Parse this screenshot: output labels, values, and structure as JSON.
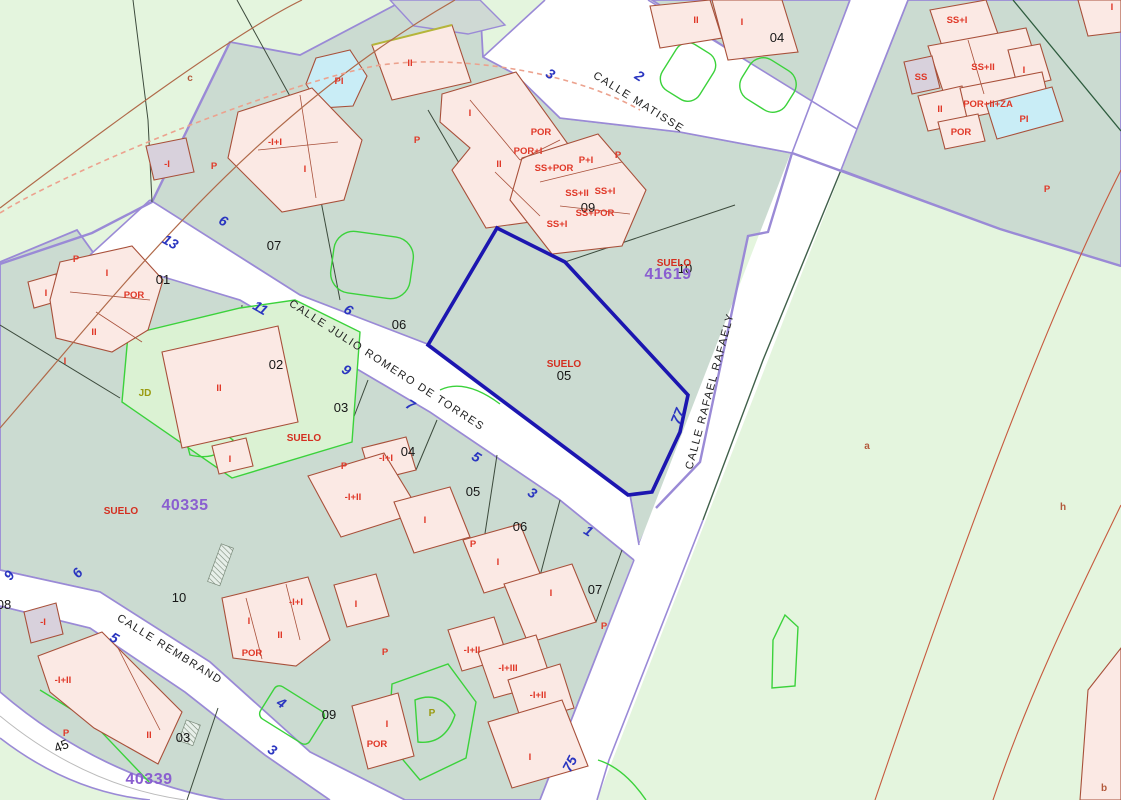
{
  "map_type": "cadastral-parcel-map",
  "colors": {
    "rustic": "#e4f5de",
    "parcel": "#cbdbd1",
    "street_edge": "#9a8ad6",
    "building_fill": "#fbe9e4",
    "building_stroke": "#a8503a",
    "pool": "#c9edf6",
    "garden_line": "#3bd23b",
    "selection": "#1c16b0",
    "label_red": "#e03828",
    "number_blue": "#2a35c0",
    "block_purple": "#8a5fd0"
  },
  "streets": [
    {
      "t": "CALLE MATISSE",
      "x": 637,
      "y": 105,
      "r": 32
    },
    {
      "t": "CALLE JULIO ROMERO DE TORRES",
      "x": 385,
      "y": 368,
      "r": 33
    },
    {
      "t": "CALLE RAFAEL RAFAELY",
      "x": 713,
      "y": 392,
      "r": -75
    },
    {
      "t": "CALLE REMBRAND",
      "x": 168,
      "y": 652,
      "r": 32
    }
  ],
  "street_numbers": [
    {
      "t": "3",
      "x": 548,
      "y": 78,
      "r": 32
    },
    {
      "t": "2",
      "x": 637,
      "y": 80,
      "r": 32
    },
    {
      "t": "6",
      "x": 221,
      "y": 225,
      "r": 30
    },
    {
      "t": "13",
      "x": 168,
      "y": 246,
      "r": 30
    },
    {
      "t": "11",
      "x": 258,
      "y": 312,
      "r": 30
    },
    {
      "t": "6",
      "x": 346,
      "y": 314,
      "r": 32
    },
    {
      "t": "9",
      "x": 344,
      "y": 374,
      "r": 32
    },
    {
      "t": "7",
      "x": 408,
      "y": 409,
      "r": 32
    },
    {
      "t": "5",
      "x": 474,
      "y": 461,
      "r": 32
    },
    {
      "t": "3",
      "x": 530,
      "y": 497,
      "r": 32
    },
    {
      "t": "1",
      "x": 586,
      "y": 535,
      "r": 32
    },
    {
      "t": "77",
      "x": 682,
      "y": 418,
      "r": -68
    },
    {
      "t": "75",
      "x": 574,
      "y": 766,
      "r": -62
    },
    {
      "t": "9",
      "x": 13,
      "y": 578,
      "r": -55
    },
    {
      "t": "6",
      "x": 81,
      "y": 576,
      "r": -50
    },
    {
      "t": "5",
      "x": 112,
      "y": 642,
      "r": 30
    },
    {
      "t": "4",
      "x": 279,
      "y": 707,
      "r": 32
    },
    {
      "t": "3",
      "x": 270,
      "y": 754,
      "r": 32
    }
  ],
  "parcel_numbers": [
    {
      "t": "04",
      "x": 777,
      "y": 42
    },
    {
      "t": "07",
      "x": 274,
      "y": 250
    },
    {
      "t": "01",
      "x": 163,
      "y": 284
    },
    {
      "t": "06",
      "x": 399,
      "y": 329
    },
    {
      "t": "02",
      "x": 276,
      "y": 369
    },
    {
      "t": "09",
      "x": 588,
      "y": 212
    },
    {
      "t": "10",
      "x": 685,
      "y": 273
    },
    {
      "t": "05",
      "x": 564,
      "y": 380
    },
    {
      "t": "03",
      "x": 341,
      "y": 412
    },
    {
      "t": "04",
      "x": 408,
      "y": 456
    },
    {
      "t": "05",
      "x": 473,
      "y": 496
    },
    {
      "t": "06",
      "x": 520,
      "y": 531
    },
    {
      "t": "07",
      "x": 595,
      "y": 594
    },
    {
      "t": "10",
      "x": 179,
      "y": 602
    },
    {
      "t": "08",
      "x": 4,
      "y": 609
    },
    {
      "t": "09",
      "x": 329,
      "y": 719
    },
    {
      "t": "03",
      "x": 183,
      "y": 742
    },
    {
      "t": "45",
      "x": 63,
      "y": 750,
      "r": -22
    }
  ],
  "block_numbers": [
    {
      "t": "41619",
      "x": 668,
      "y": 279
    },
    {
      "t": "40335",
      "x": 185,
      "y": 510
    },
    {
      "t": "40339",
      "x": 149,
      "y": 784
    }
  ],
  "land_labels": [
    {
      "t": "SUELO",
      "x": 674,
      "y": 266
    },
    {
      "t": "SUELO",
      "x": 564,
      "y": 367
    },
    {
      "t": "SUELO",
      "x": 304,
      "y": 441
    },
    {
      "t": "SUELO",
      "x": 121,
      "y": 514
    },
    {
      "t": "JD",
      "x": 145,
      "y": 396,
      "cl": "olive"
    },
    {
      "t": "P",
      "x": 432,
      "y": 716,
      "cl": "olive"
    }
  ],
  "building_labels": [
    {
      "t": "II",
      "x": 696,
      "y": 23
    },
    {
      "t": "I",
      "x": 742,
      "y": 25
    },
    {
      "t": "I",
      "x": 1112,
      "y": 10
    },
    {
      "t": "SS+I",
      "x": 957,
      "y": 23
    },
    {
      "t": "SS+II",
      "x": 983,
      "y": 70
    },
    {
      "t": "SS",
      "x": 921,
      "y": 80
    },
    {
      "t": "I",
      "x": 1024,
      "y": 73
    },
    {
      "t": "II",
      "x": 940,
      "y": 112
    },
    {
      "t": "POR+II+ZA",
      "x": 988,
      "y": 107
    },
    {
      "t": "POR",
      "x": 961,
      "y": 135
    },
    {
      "t": "PI",
      "x": 1024,
      "y": 122
    },
    {
      "t": "P",
      "x": 1047,
      "y": 192
    },
    {
      "t": "II",
      "x": 410,
      "y": 66
    },
    {
      "t": "PI",
      "x": 339,
      "y": 84
    },
    {
      "t": "I",
      "x": 470,
      "y": 116
    },
    {
      "t": "POR",
      "x": 541,
      "y": 135
    },
    {
      "t": "POR+I",
      "x": 528,
      "y": 154
    },
    {
      "t": "II",
      "x": 499,
      "y": 167
    },
    {
      "t": "P",
      "x": 417,
      "y": 143
    },
    {
      "t": "P",
      "x": 618,
      "y": 158
    },
    {
      "t": "P+I",
      "x": 586,
      "y": 163
    },
    {
      "t": "SS+POR",
      "x": 554,
      "y": 171
    },
    {
      "t": "SS+II",
      "x": 577,
      "y": 196
    },
    {
      "t": "SS+I",
      "x": 605,
      "y": 194
    },
    {
      "t": "SS+POR",
      "x": 595,
      "y": 216
    },
    {
      "t": "SS+I",
      "x": 557,
      "y": 227
    },
    {
      "t": "P",
      "x": 214,
      "y": 169
    },
    {
      "t": "-I",
      "x": 167,
      "y": 167
    },
    {
      "t": "-I+I",
      "x": 275,
      "y": 145
    },
    {
      "t": "I",
      "x": 305,
      "y": 172
    },
    {
      "t": "P",
      "x": 76,
      "y": 262
    },
    {
      "t": "I",
      "x": 46,
      "y": 296
    },
    {
      "t": "I",
      "x": 107,
      "y": 276
    },
    {
      "t": "POR",
      "x": 134,
      "y": 298
    },
    {
      "t": "II",
      "x": 94,
      "y": 335
    },
    {
      "t": "I",
      "x": 65,
      "y": 364
    },
    {
      "t": "II",
      "x": 219,
      "y": 391
    },
    {
      "t": "I",
      "x": 230,
      "y": 462
    },
    {
      "t": "P",
      "x": 344,
      "y": 469
    },
    {
      "t": "-I+I",
      "x": 386,
      "y": 461
    },
    {
      "t": "-I+II",
      "x": 353,
      "y": 500
    },
    {
      "t": "I",
      "x": 425,
      "y": 523
    },
    {
      "t": "P",
      "x": 473,
      "y": 547
    },
    {
      "t": "I",
      "x": 498,
      "y": 565
    },
    {
      "t": "I",
      "x": 551,
      "y": 596
    },
    {
      "t": "P",
      "x": 604,
      "y": 629
    },
    {
      "t": "-I+I",
      "x": 296,
      "y": 605
    },
    {
      "t": "I",
      "x": 249,
      "y": 624
    },
    {
      "t": "II",
      "x": 280,
      "y": 638
    },
    {
      "t": "POR",
      "x": 252,
      "y": 656
    },
    {
      "t": "I",
      "x": 356,
      "y": 607
    },
    {
      "t": "P",
      "x": 385,
      "y": 655
    },
    {
      "t": "-I+II",
      "x": 472,
      "y": 653
    },
    {
      "t": "-I+III",
      "x": 508,
      "y": 671
    },
    {
      "t": "-I+II",
      "x": 538,
      "y": 698
    },
    {
      "t": "I",
      "x": 387,
      "y": 727
    },
    {
      "t": "POR",
      "x": 377,
      "y": 747
    },
    {
      "t": "I",
      "x": 530,
      "y": 760
    },
    {
      "t": "-I",
      "x": 43,
      "y": 625
    },
    {
      "t": "-I+II",
      "x": 63,
      "y": 683
    },
    {
      "t": "P",
      "x": 66,
      "y": 736
    },
    {
      "t": "II",
      "x": 149,
      "y": 738
    }
  ],
  "zone_letters": [
    {
      "t": "c",
      "x": 190,
      "y": 81
    },
    {
      "t": "a",
      "x": 867,
      "y": 449
    },
    {
      "t": "h",
      "x": 1063,
      "y": 510
    },
    {
      "t": "b",
      "x": 1104,
      "y": 791
    }
  ]
}
